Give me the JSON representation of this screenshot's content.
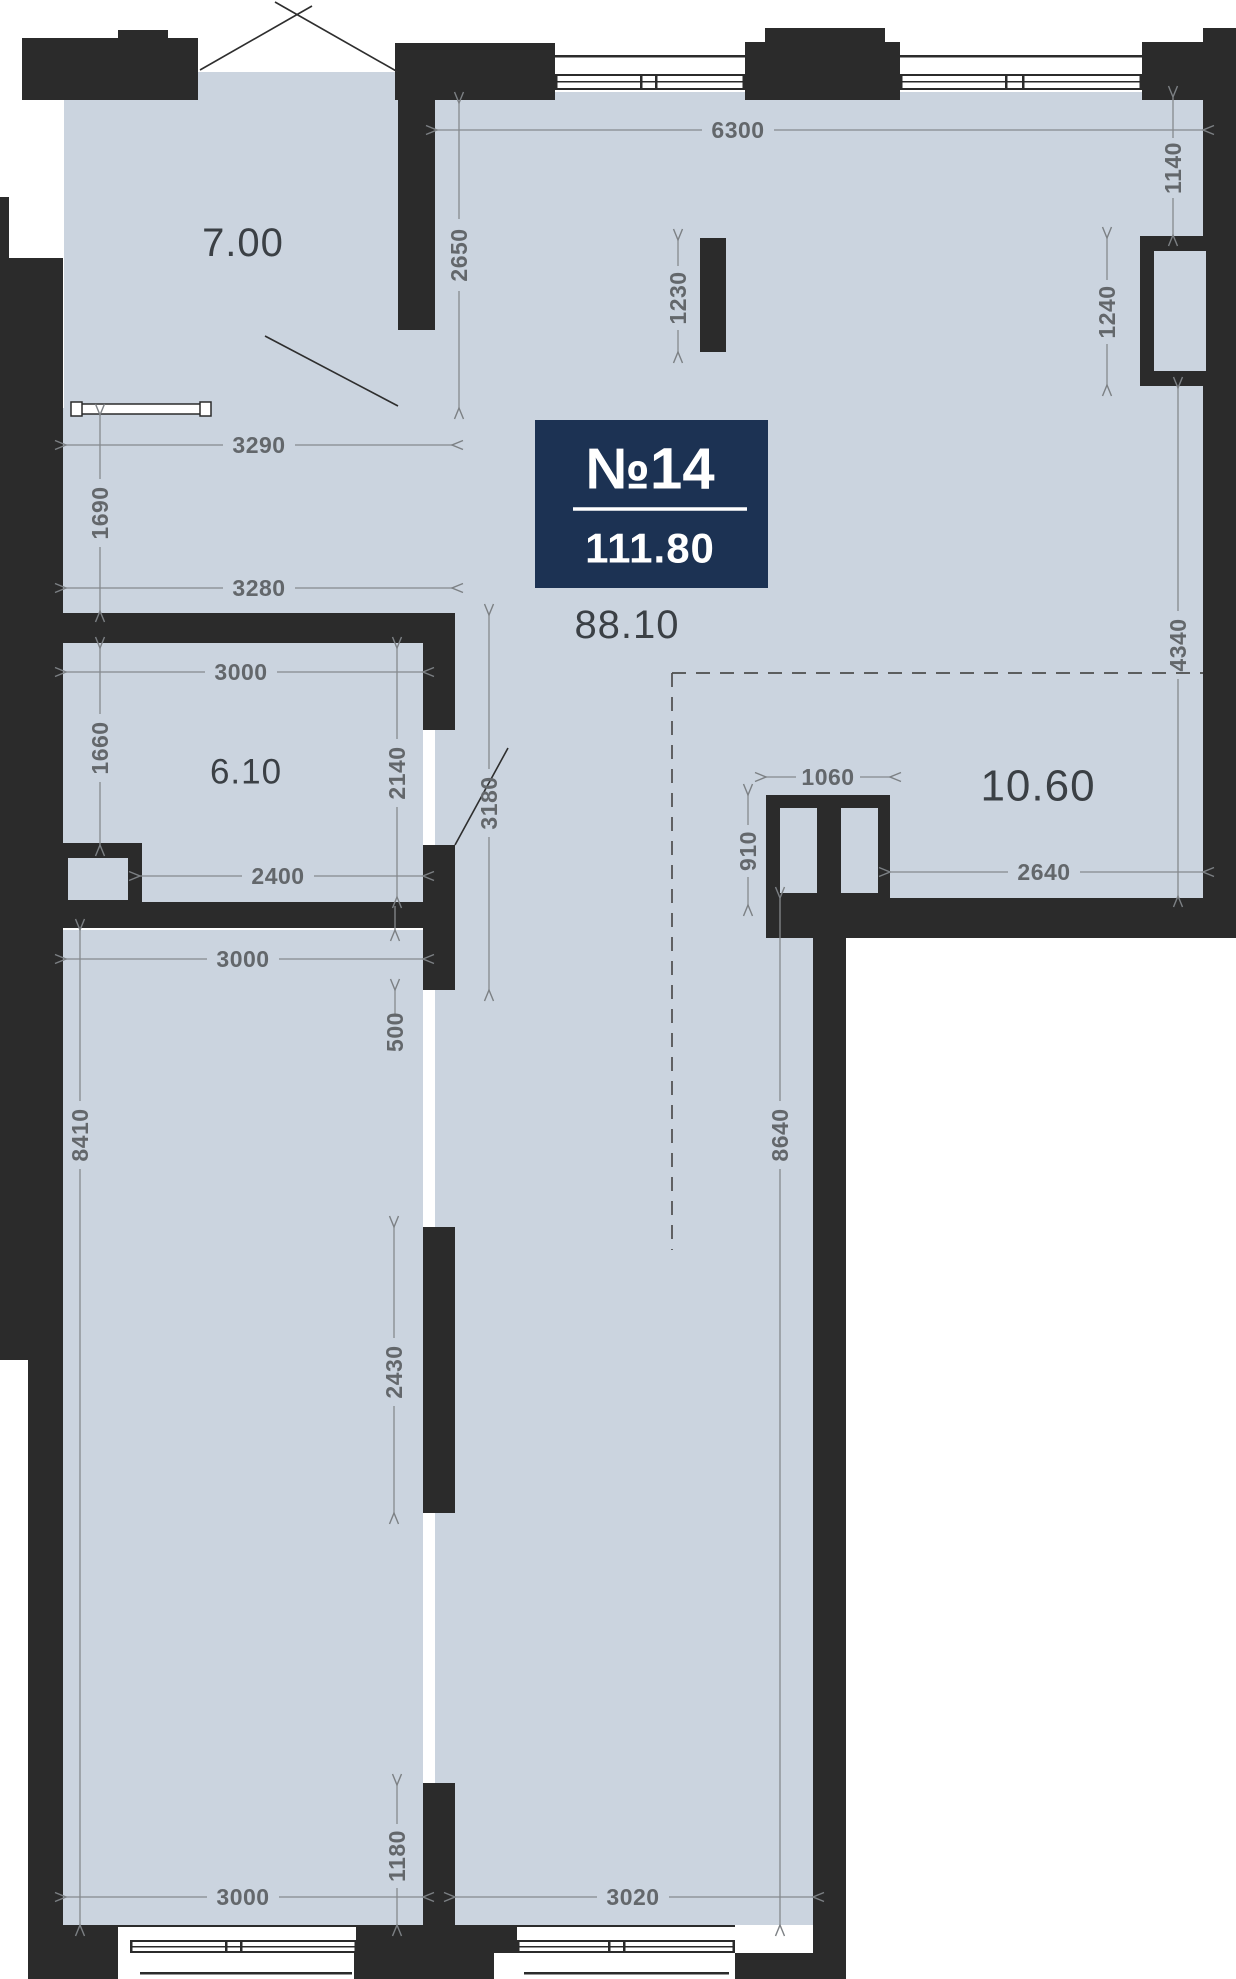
{
  "plan": {
    "badge": {
      "number": "№14",
      "area": "111.80"
    },
    "rooms": [
      {
        "id": "room-7-00",
        "label": "7.00",
        "x": 243,
        "y": 243,
        "size": 40
      },
      {
        "id": "room-6-10",
        "label": "6.10",
        "x": 246,
        "y": 772,
        "size": 35
      },
      {
        "id": "area-88-10",
        "label": "88.10",
        "x": 627,
        "y": 625,
        "size": 40
      },
      {
        "id": "area-10-60",
        "label": "10.60",
        "x": 1038,
        "y": 786,
        "size": 44
      }
    ],
    "dimensions": [
      {
        "id": "6300",
        "value": "6300",
        "x1": 437,
        "y1": 130,
        "x2": 1203,
        "y2": 130,
        "tx": 738,
        "ty": 130,
        "gap": 36
      },
      {
        "id": "2650",
        "value": "2650",
        "x1": 459,
        "y1": 103,
        "x2": 459,
        "y2": 408,
        "tx": 459,
        "ty": 255,
        "gap": 36,
        "vertical": true
      },
      {
        "id": "1230",
        "value": "1230",
        "x1": 678,
        "y1": 240,
        "x2": 678,
        "y2": 352,
        "tx": 678,
        "ty": 298,
        "gap": 32,
        "vertical": true
      },
      {
        "id": "1140",
        "value": "1140",
        "x1": 1173,
        "y1": 97,
        "x2": 1173,
        "y2": 235,
        "tx": 1173,
        "ty": 168,
        "gap": 30,
        "vertical": true
      },
      {
        "id": "1240",
        "value": "1240",
        "x1": 1107,
        "y1": 238,
        "x2": 1107,
        "y2": 385,
        "tx": 1107,
        "ty": 312,
        "gap": 32,
        "vertical": true
      },
      {
        "id": "4340",
        "value": "4340",
        "x1": 1178,
        "y1": 388,
        "x2": 1178,
        "y2": 896,
        "tx": 1178,
        "ty": 645,
        "gap": 34,
        "vertical": true
      },
      {
        "id": "3290",
        "value": "3290",
        "x1": 66,
        "y1": 445,
        "x2": 452,
        "y2": 445,
        "tx": 259,
        "ty": 445,
        "gap": 36
      },
      {
        "id": "1690",
        "value": "1690",
        "x1": 100,
        "y1": 415,
        "x2": 100,
        "y2": 611,
        "tx": 100,
        "ty": 513,
        "gap": 34,
        "vertical": true
      },
      {
        "id": "3280",
        "value": "3280",
        "x1": 66,
        "y1": 588,
        "x2": 452,
        "y2": 588,
        "tx": 259,
        "ty": 588,
        "gap": 36
      },
      {
        "id": "3000-mid",
        "value": "3000",
        "x1": 66,
        "y1": 672,
        "x2": 423,
        "y2": 672,
        "tx": 241,
        "ty": 672,
        "gap": 36
      },
      {
        "id": "1660",
        "value": "1660",
        "x1": 100,
        "y1": 648,
        "x2": 100,
        "y2": 845,
        "tx": 100,
        "ty": 748,
        "gap": 34,
        "vertical": true
      },
      {
        "id": "2140",
        "value": "2140",
        "x1": 397,
        "y1": 648,
        "x2": 397,
        "y2": 897,
        "tx": 397,
        "ty": 773,
        "gap": 34,
        "vertical": true
      },
      {
        "id": "3180",
        "value": "3180",
        "x1": 489,
        "y1": 615,
        "x2": 489,
        "y2": 990,
        "tx": 489,
        "ty": 803,
        "gap": 34,
        "vertical": true
      },
      {
        "id": "2400",
        "value": "2400",
        "x1": 140,
        "y1": 876,
        "x2": 423,
        "y2": 876,
        "tx": 278,
        "ty": 876,
        "gap": 36
      },
      {
        "id": "1060",
        "value": "1060",
        "x1": 766,
        "y1": 777,
        "x2": 890,
        "y2": 777,
        "tx": 828,
        "ty": 777,
        "gap": 32
      },
      {
        "id": "910",
        "value": "910",
        "x1": 748,
        "y1": 795,
        "x2": 748,
        "y2": 905,
        "tx": 748,
        "ty": 851,
        "gap": 26,
        "vertical": true
      },
      {
        "id": "2640",
        "value": "2640",
        "x1": 890,
        "y1": 872,
        "x2": 1203,
        "y2": 872,
        "tx": 1044,
        "ty": 872,
        "gap": 36
      },
      {
        "id": "3000-bl",
        "value": "3000",
        "x1": 66,
        "y1": 959,
        "x2": 423,
        "y2": 959,
        "tx": 243,
        "ty": 959,
        "gap": 36
      },
      {
        "id": "500",
        "value": "500",
        "x1": 395,
        "y1": 930,
        "x2": 395,
        "y2": 990,
        "tx": 395,
        "ty": 1032,
        "style": "outside_v",
        "vertical": true
      },
      {
        "id": "2430",
        "value": "2430",
        "x1": 394,
        "y1": 1227,
        "x2": 394,
        "y2": 1513,
        "tx": 394,
        "ty": 1372,
        "gap": 34,
        "vertical": true
      },
      {
        "id": "8410",
        "value": "8410",
        "x1": 80,
        "y1": 930,
        "x2": 80,
        "y2": 1925,
        "tx": 80,
        "ty": 1135,
        "gap": 34,
        "vertical": true
      },
      {
        "id": "8640",
        "value": "8640",
        "x1": 780,
        "y1": 898,
        "x2": 780,
        "y2": 1925,
        "tx": 780,
        "ty": 1135,
        "gap": 34,
        "vertical": true
      },
      {
        "id": "1180",
        "value": "1180",
        "x1": 397,
        "y1": 1785,
        "x2": 397,
        "y2": 1925,
        "tx": 397,
        "ty": 1856,
        "gap": 32,
        "vertical": true
      },
      {
        "id": "3000-bottom",
        "value": "3000",
        "x1": 66,
        "y1": 1897,
        "x2": 423,
        "y2": 1897,
        "tx": 243,
        "ty": 1897,
        "gap": 36
      },
      {
        "id": "3020",
        "value": "3020",
        "x1": 455,
        "y1": 1897,
        "x2": 813,
        "y2": 1897,
        "tx": 633,
        "ty": 1897,
        "gap": 36
      }
    ],
    "colors": {
      "wall": "#2b2b2b",
      "floor": "#cbd4df",
      "dim": "#63676b",
      "badge_bg": "#1c3253",
      "label": "#3b4045"
    }
  }
}
